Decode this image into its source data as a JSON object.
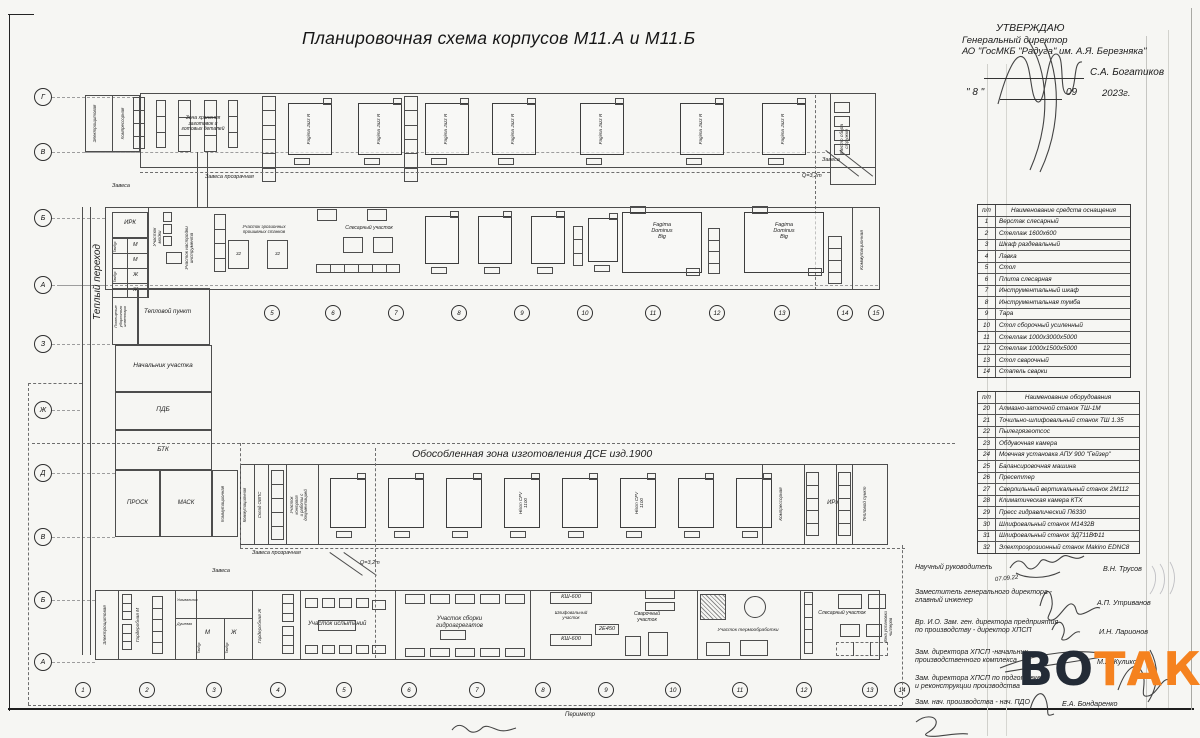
{
  "sheet": {
    "title": "Планировочная схема корпусов М11.А и М11.Б"
  },
  "approval": {
    "approve": "УТВЕРЖДАЮ",
    "role1": "Генеральный директор",
    "role2": "АО \"ГосМКБ \"Радуга\" им. А.Я. Березняка\"",
    "name": "С.А. Богатиков",
    "day_q": "\" 8 \"",
    "month": "09",
    "year": "2023г."
  },
  "tables": {
    "tooling": {
      "num_header": "п/п",
      "name_header": "Наименование средств оснащения",
      "rows": [
        [
          "1",
          "Верстак слесарный"
        ],
        [
          "2",
          "Стеллаж 1600х600"
        ],
        [
          "3",
          "Шкаф раздевальный"
        ],
        [
          "4",
          "Лавка"
        ],
        [
          "5",
          "Стол"
        ],
        [
          "6",
          "Плита слесарная"
        ],
        [
          "7",
          "Инструментальный шкаф"
        ],
        [
          "8",
          "Инструментальная тумба"
        ],
        [
          "9",
          "Тара"
        ],
        [
          "10",
          "Стол сборочный усиленный"
        ],
        [
          "11",
          "Стеллаж 1000х3000х5000"
        ],
        [
          "12",
          "Стеллаж 1000х1500х5000"
        ],
        [
          "13",
          "Стол сварочный"
        ],
        [
          "14",
          "Стапель сварки"
        ]
      ]
    },
    "equipment": {
      "num_header": "п/п",
      "name_header": "Наименование оборудования",
      "rows": [
        [
          "20",
          "Алмазно-заточной станок ТШ-1М"
        ],
        [
          "21",
          "Точильно-шлифовальный станок ТШ 1.35"
        ],
        [
          "22",
          "Пылегрязеотсос"
        ],
        [
          "23",
          "Обдувочная камера"
        ],
        [
          "24",
          "Моечная установка АПУ 900 \"Гейзер\""
        ],
        [
          "25",
          "Балансировочная машина"
        ],
        [
          "26",
          "Пресеттер"
        ],
        [
          "27",
          "Сверлильный вертикальный станок 2М112"
        ],
        [
          "28",
          "Климатическая камера КТХ"
        ],
        [
          "29",
          "Пресс гидравлический П6330"
        ],
        [
          "30",
          "Шлифовальный станок М1432В"
        ],
        [
          "31",
          "Шлифовальный станок 3Д711ВФ11"
        ],
        [
          "32",
          "Электроэрозионный станок Makino EDNC8"
        ]
      ]
    }
  },
  "signatures": [
    {
      "role": "Научный руководитель",
      "name": "В.Н. Трусов",
      "note": "07.09.22"
    },
    {
      "role": "Заместитель генерального директора -\nглавный инженер",
      "name": "А.П. Утриванов"
    },
    {
      "role": "Вр. И.О. Зам. ген. директора предприятия\nпо производству - директор ХПСП",
      "name": "И.Н. Ларионов"
    },
    {
      "role": "Зам. директора ХПСП -начальник\nпроизводственного комплекса",
      "name": "М.А. Куликов"
    },
    {
      "role": "Зам. директора ХПСП по подготовке\nи реконструкции производства",
      "name": ""
    },
    {
      "role": "Зам. нач. производства - нач. ПДО",
      "name": "Е.А. Бондаренко"
    }
  ],
  "watermark": {
    "left": "ВО",
    "right": "ТАК",
    "left_color": "#232b36",
    "right_color": "#f5821f"
  },
  "plan": {
    "axes_left": [
      "Г",
      "В",
      "Б",
      "А",
      "З",
      "Ж",
      "Д",
      "В",
      "Б",
      "А"
    ],
    "cols_mid": [
      "5",
      "6",
      "7",
      "8",
      "9",
      "10",
      "11",
      "12",
      "13",
      "14",
      "15"
    ],
    "cols_bottom": [
      "1",
      "2",
      "3",
      "4",
      "5",
      "6",
      "7",
      "8",
      "9",
      "10",
      "11",
      "12",
      "13",
      "14"
    ],
    "labels": {
      "storage": "Зона хранения\nзаготовок и\nготовых деталей",
      "chips": "Место сбора\nстружки",
      "electro": "Электрощитовая",
      "compressor": "Компрессорная",
      "curtain": "Завеса",
      "curtain_tr": "Завеса прозрачная",
      "q32": "Q=3,2m",
      "warm": "Теплый переход",
      "irk": "ИРК",
      "wash_area": "Участок\nмойки",
      "tool_setup": "Участок настройки\nинструмента",
      "edm_area": "Участок эрозионных\nпрошивных станков",
      "bench_area": "Слесарный участок",
      "m": "М",
      "zh": "Ж",
      "tambour": "Тамбур",
      "cleaning": "Помещение\nуборочного\nинвентаря",
      "heat_point": "Тепловой пункт",
      "chief": "Начальник участка",
      "pdb": "ПДБ",
      "btk": "БТК",
      "prosk": "ПРОСК",
      "mask": "МАСК",
      "comm": "Коммутационная",
      "isolated": "Обособленная зона изготовления ДСЕ изд.1900",
      "sklad": "Склад ОВПС",
      "control": "Участок\nконтроля\nи работы с\nдокументацией",
      "gard_m": "Гардеробная М",
      "gard_zh": "Гардеробная Ж",
      "shower": "Душевая",
      "wash": "Умывальник",
      "test": "Участок испытаний",
      "hydro": "Участок сборки\nгидроагрегатов",
      "ksh": "КШ-600",
      "e450": "2Е450",
      "grind": "Шлифовальный\nучасток",
      "weld": "Сварочный\nучасток",
      "heat_tr": "Участок термообработки",
      "chiller": "Зона установки\nчиллеров",
      "perimeter": "Периметр",
      "ref32": "32"
    },
    "machines": {
      "jazz": "Fagima Jazz R",
      "dominus": "Fagima\nDominus\nBig",
      "hison": "Hison CFV\n1100"
    }
  }
}
